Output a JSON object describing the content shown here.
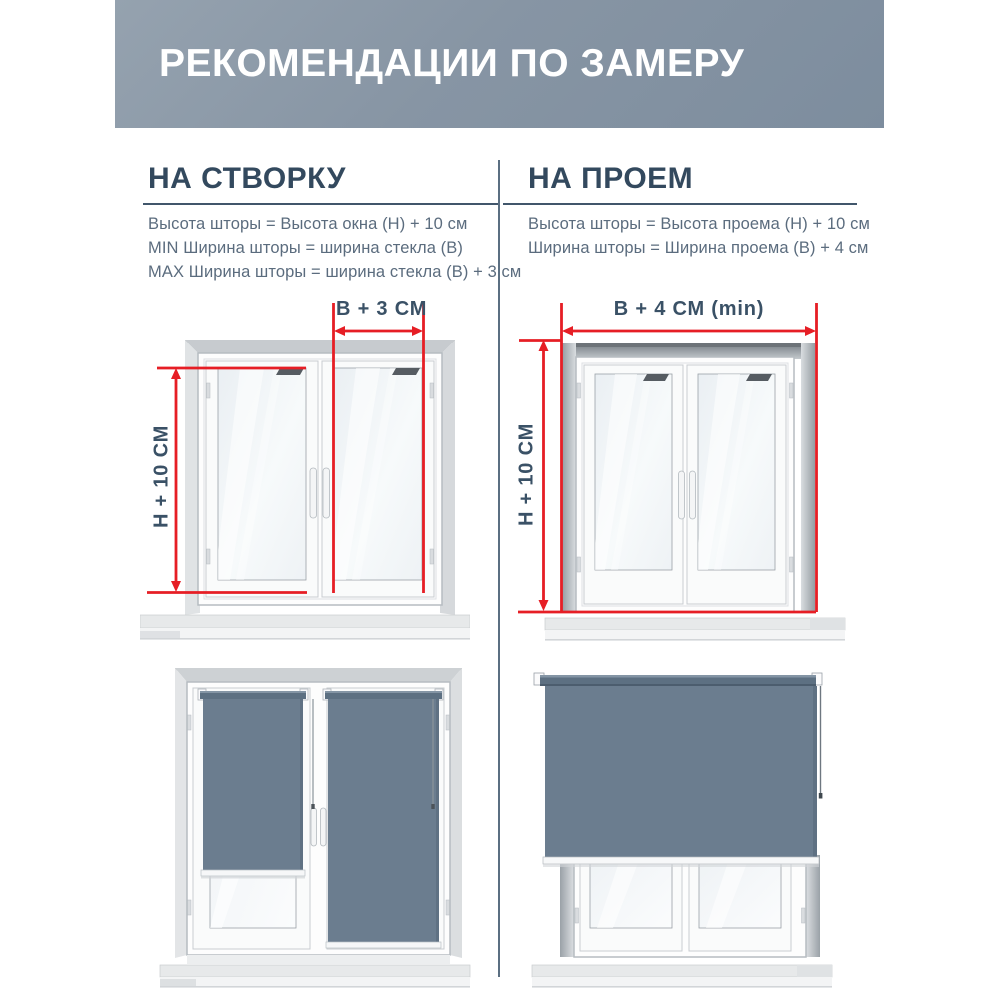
{
  "header": {
    "title": "РЕКОМЕНДАЦИИ ПО ЗАМЕРУ"
  },
  "columns": {
    "left": {
      "heading": "НА СТВОРКУ",
      "rules": [
        "Высота шторы = Высота окна (Н) + 10 см",
        "MIN Ширина шторы = ширина стекла (В)",
        "MAX Ширина шторы = ширина стекла (В) + 3 см"
      ],
      "width_label": "В + 3 СМ",
      "height_label": "Н + 10 СМ"
    },
    "right": {
      "heading": "НА ПРОЕМ",
      "rules": [
        "Высота шторы = Высота проема (Н) + 10 см",
        "Ширина шторы = Ширина проема (В) + 4 см"
      ],
      "width_label": "В + 4 СМ (min)",
      "height_label": "Н + 10 СМ"
    }
  },
  "colors": {
    "accent_red": "#e61e25",
    "heading_text": "#33495e",
    "body_text": "#5b6c7e",
    "header_bg": "#8795a4",
    "blind_fabric": "#6b7d8f",
    "blind_tube": "#5d7082",
    "divider": "#5b6f82"
  }
}
